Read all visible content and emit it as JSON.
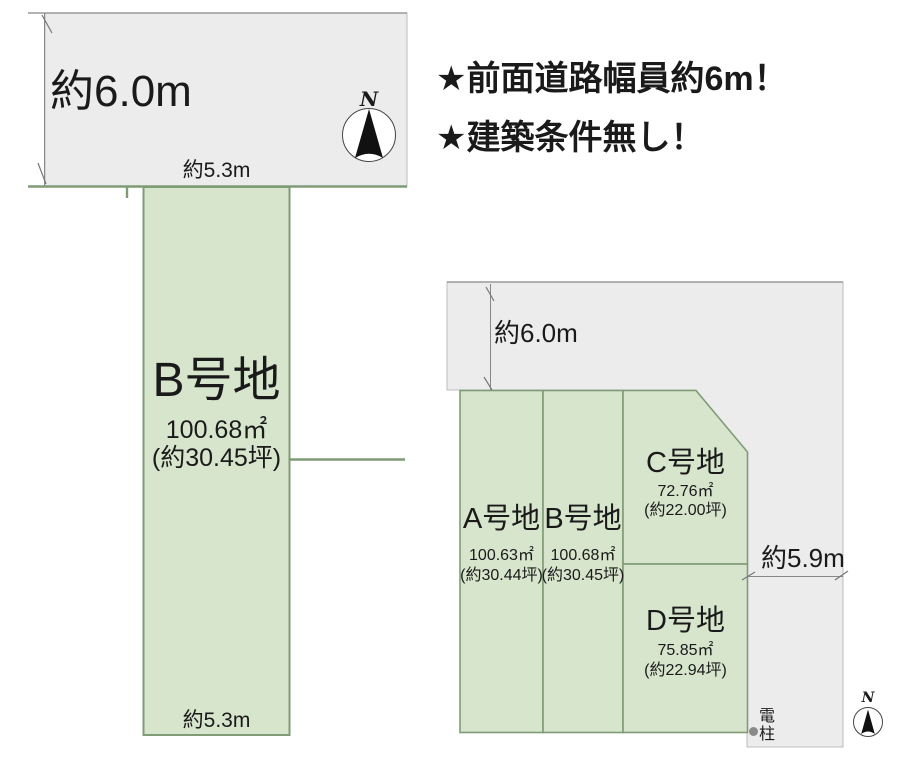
{
  "headline": {
    "line1": "★前面道路幅員約6m！",
    "line2": "★建築条件無し！"
  },
  "left_diagram": {
    "road_width_label": "約6.0m",
    "frontage_top_label": "約5.3m",
    "frontage_bottom_label": "約5.3m",
    "compass_label": "N",
    "plot": {
      "name": "B号地",
      "area_m2": "100.68㎡",
      "area_tsubo": "(約30.45坪)"
    }
  },
  "right_diagram": {
    "road_width_top_label": "約6.0m",
    "road_width_side_label": "約5.9m",
    "compass_label": "N",
    "utility_pole_label": "電柱",
    "plots": [
      {
        "name": "A号地",
        "area_m2": "100.63㎡",
        "area_tsubo": "(約30.44坪)"
      },
      {
        "name": "B号地",
        "area_m2": "100.68㎡",
        "area_tsubo": "(約30.45坪)"
      },
      {
        "name": "C号地",
        "area_m2": "72.76㎡",
        "area_tsubo": "(約22.00坪)"
      },
      {
        "name": "D号地",
        "area_m2": "75.85㎡",
        "area_tsubo": "(約22.94坪)"
      }
    ]
  },
  "colors": {
    "plot_fill": "#d6e5cc",
    "plot_border": "#7f9c76",
    "road_fill": "#ececec",
    "road_border": "#bdbdbd",
    "road_edge": "#9a9a9a",
    "dimension_line": "#888888",
    "text": "#1a1a1a",
    "pole_dot": "#8a8a8a"
  }
}
